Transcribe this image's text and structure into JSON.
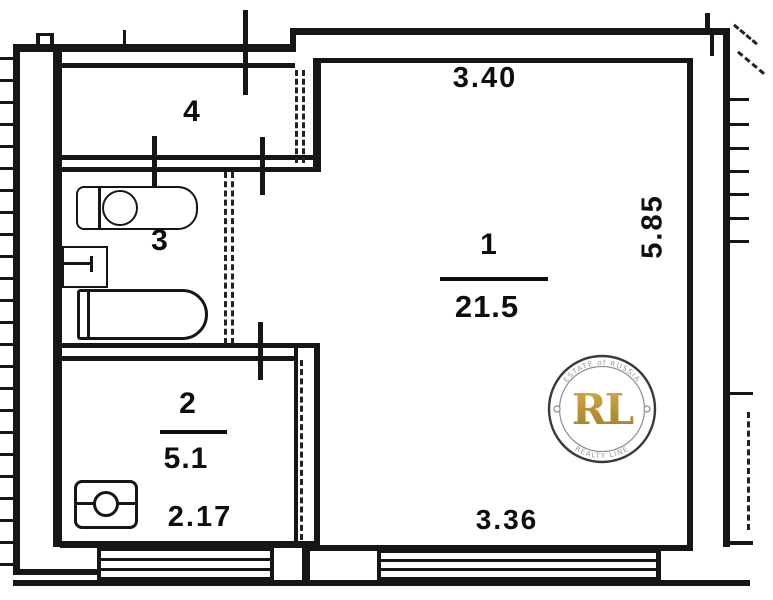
{
  "floorplan": {
    "rooms": [
      {
        "number": "1",
        "area": "21.5"
      },
      {
        "number": "2",
        "area": "5.1"
      },
      {
        "number": "3"
      },
      {
        "number": "4"
      }
    ],
    "dimensions": {
      "top_width": "3.40",
      "right_height": "5.85",
      "bottom_width": "3.36",
      "kitchen_width": "2.17"
    },
    "line_color": "#161616"
  },
  "watermark": {
    "arc_top": "ESTATE of RUSSIA",
    "monogram": "RL",
    "arc_bottom": "REALTY LINE",
    "gold_color": "#b5912c"
  }
}
